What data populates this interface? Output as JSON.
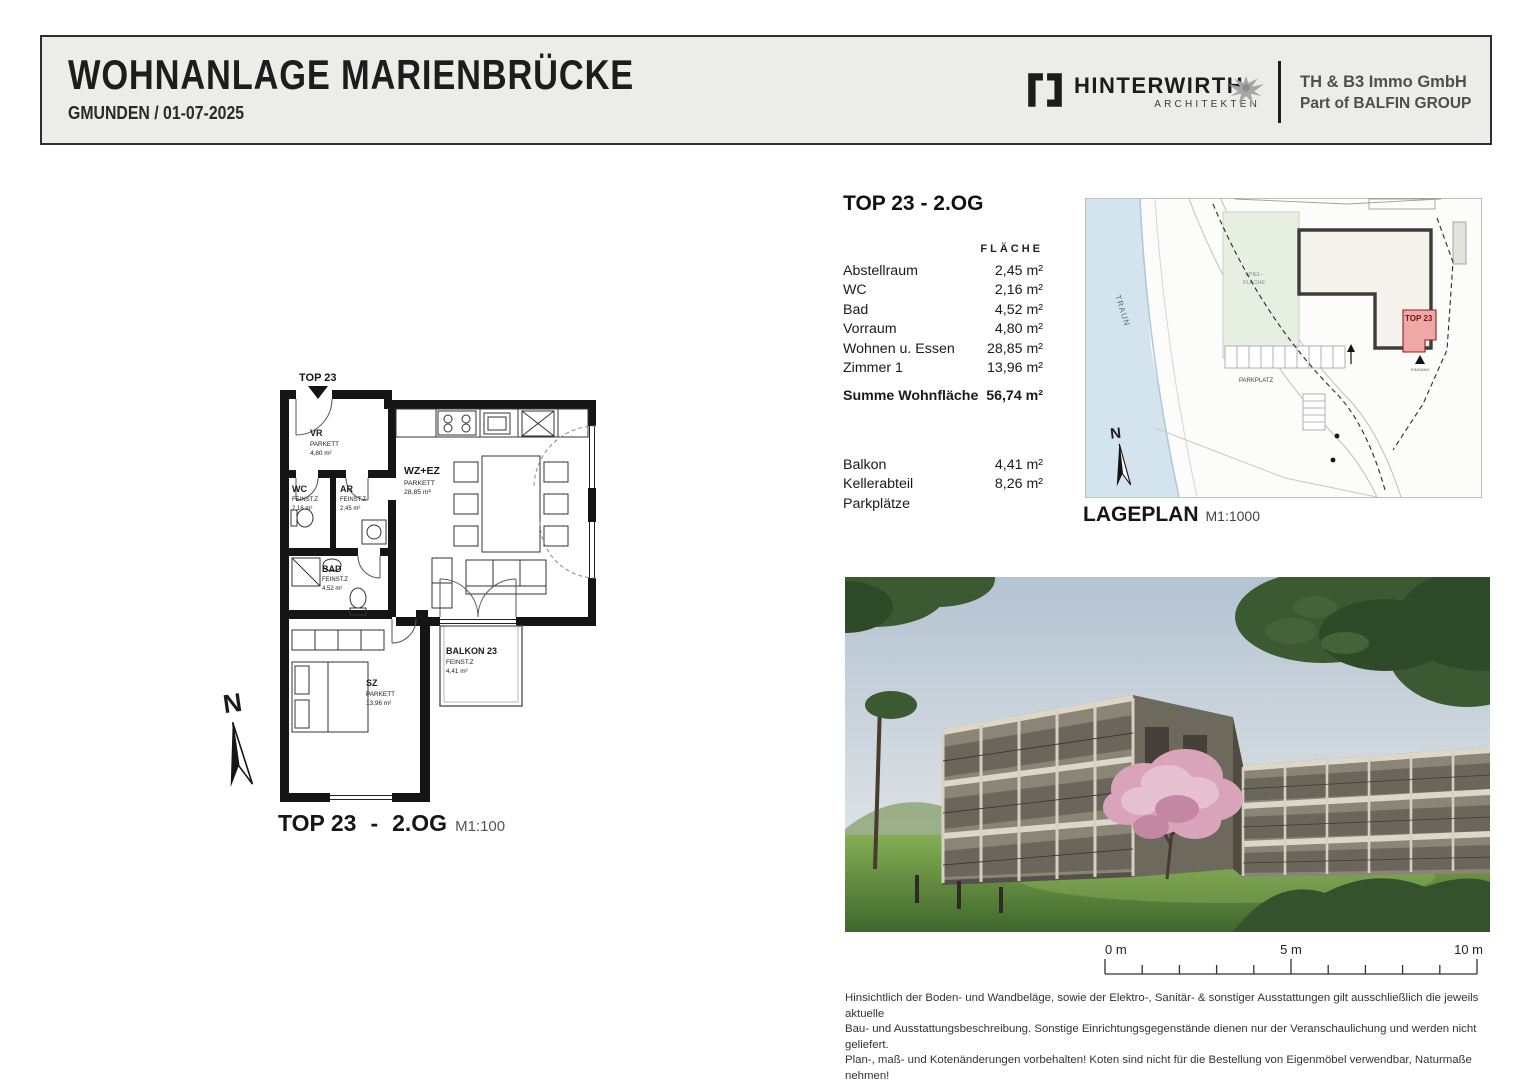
{
  "header": {
    "title": "WOHNANLAGE  MARIENBRÜCKE",
    "subtitle": "GMUNDEN  /  01-07-2025",
    "architect_name": "HINTERWIRTH",
    "architect_sub": "ARCHITEKTEN",
    "company_line1": "TH & B3 Immo GmbH",
    "company_line2": "Part of BALFIN GROUP"
  },
  "unit_info": {
    "heading": "TOP 23 - 2.OG",
    "col_header": "FLÄCHE",
    "rooms": [
      {
        "label": "Abstellraum",
        "value": "2,45 m²"
      },
      {
        "label": "WC",
        "value": "2,16 m²"
      },
      {
        "label": "Bad",
        "value": "4,52 m²"
      },
      {
        "label": "Vorraum",
        "value": "4,80 m²"
      },
      {
        "label": "Wohnen u. Essen",
        "value": "28,85 m²"
      },
      {
        "label": "Zimmer  1",
        "value": "13,96 m²"
      }
    ],
    "total_label": "Summe Wohnfläche",
    "total_value": "56,74 m²",
    "extras": [
      {
        "label": "Balkon",
        "value": "4,41 m²"
      },
      {
        "label": "Kellerabteil",
        "value": "8,26 m²"
      },
      {
        "label": "Parkplätze",
        "value": ""
      }
    ]
  },
  "floorplan": {
    "unit_label": "TOP 23",
    "north_label": "N",
    "caption": "TOP 23",
    "caption_dash": "-",
    "caption_level": "2.OG",
    "caption_scale": "M1:100",
    "rooms": [
      {
        "name": "VR",
        "finish": "PARKETT",
        "area": "4,80 m²"
      },
      {
        "name": "WC",
        "finish": "FEINST.Z",
        "area": "2,16 m²"
      },
      {
        "name": "AR",
        "finish": "FEINST.Z",
        "area": "2,45 m²"
      },
      {
        "name": "WZ+EZ",
        "finish": "PARKETT",
        "area": "28,85 m²"
      },
      {
        "name": "BAD",
        "finish": "FEINST.Z",
        "area": "4,52 m²"
      },
      {
        "name": "SZ",
        "finish": "PARKETT",
        "area": "13,96 m²"
      },
      {
        "name": "BALKON 23",
        "finish": "FEINST.Z",
        "area": "4,41 m²"
      }
    ]
  },
  "siteplan": {
    "caption": "LAGEPLAN",
    "caption_scale": "M1:1000",
    "river_label": "TRAUN",
    "street_label": "An der Marienbrücke",
    "green_label_1": "SPIEL-",
    "green_label_2": "FLÄCHE",
    "parking_label": "PARKPLATZ",
    "unit_label": "TOP 23",
    "entrance_label": "EINGANG",
    "north_label": "N",
    "highlight_color": "#f0a8a6",
    "river_color": "#d4e4ef",
    "green_color": "#e6efe2"
  },
  "scalebar": {
    "labels": [
      "0 m",
      "5 m",
      "10 m"
    ]
  },
  "footer": {
    "lines": [
      "Hinsichtlich der Boden- und Wandbeläge, sowie der Elektro-, Sanitär- & sonstiger Ausstattungen gilt ausschließlich die jeweils aktuelle",
      "Bau- und Ausstattungsbeschreibung. Sonstige Einrichtungsgegenstände dienen nur der Veranschaulichung und werden nicht geliefert.",
      "Plan-, maß- und Kotenänderungen vorbehalten! Koten sind nicht für die Bestellung von Eigenmöbel verwendbar, Naturmaße nehmen!"
    ]
  }
}
